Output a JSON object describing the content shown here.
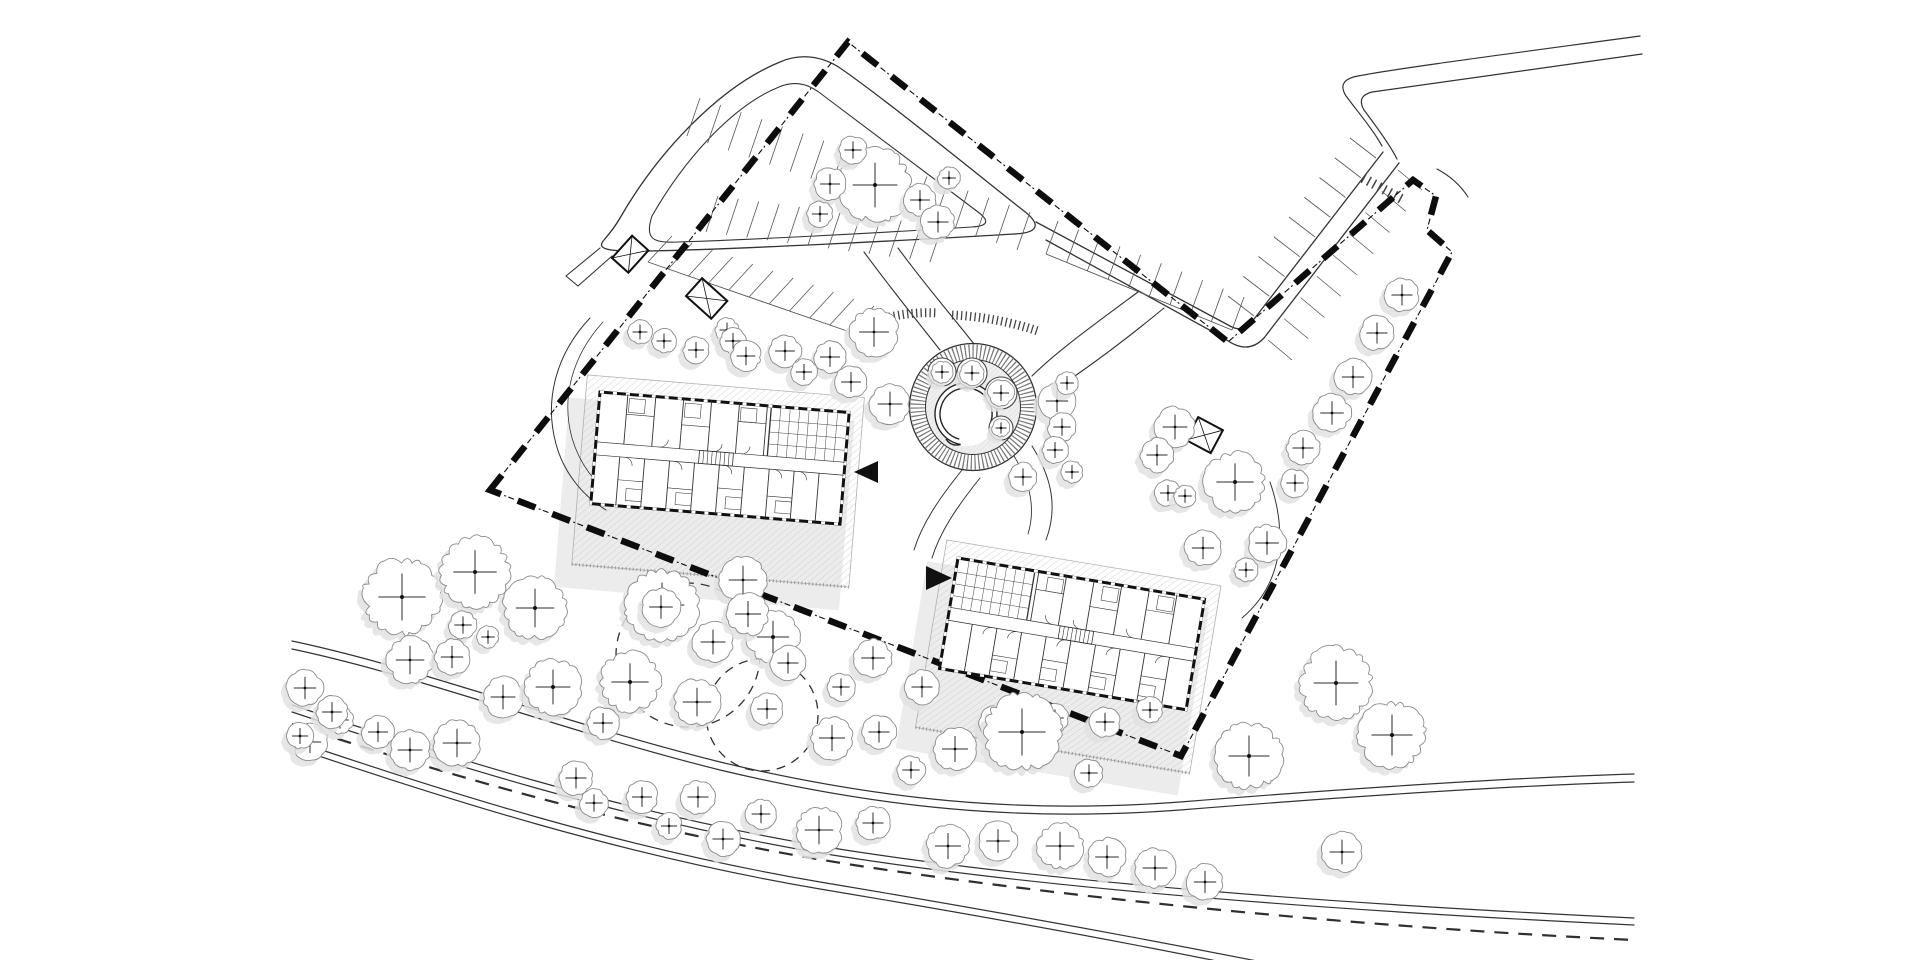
{
  "plan": {
    "kind": "architectural-site-plan",
    "canvas": {
      "w": 1920,
      "h": 960,
      "background": "#ffffff"
    },
    "colors": {
      "line": "#333333",
      "bold": "#111111",
      "tree_stroke": "#8b8b8b",
      "shadow": "#e2e2e2",
      "pad_hatch": "#c9c9c9",
      "pad_edge": "#b0b0b0",
      "stall": "#555555",
      "boundary": "#0d0d0d",
      "plaza_fill": "#efefef"
    },
    "boundary": {
      "path": "M 490,490 L 848,42 L 1228,342 L 1413,180 L 1436,196 L 1427,230 L 1452,252 L 1181,756 Z",
      "thick_dash": "19 18",
      "thin_dash": "0 23 6 2.5 2 3.5",
      "thick_width": 6.5,
      "thin_width": 1.1
    },
    "roads": [
      {
        "name": "top-loop-outer",
        "d": "M 620,218 C 658,152 720,86 780,62 C 800,53 822,56 840,68 C 884,98 992,186 1024,211 C 1042,225 1038,233 1014,234 C 898,241 738,249 650,251 C 606,252 596,249 604,240 C 610,233 615,227 620,218 Z",
        "w": 1.3
      },
      {
        "name": "top-loop-inner",
        "d": "M 652,216 C 684,160 732,106 779,87 C 793,81 807,83 820,93 C 860,123 950,191 978,212 C 990,221 988,226 972,227 C 878,233 744,240 678,242 C 654,243 644,240 652,216 Z",
        "w": 1.1
      },
      {
        "name": "stub-a",
        "d": "M 600,248 L 566,276",
        "w": 1.1
      },
      {
        "name": "stub-b",
        "d": "M 612,256 L 578,286",
        "w": 1.1
      },
      {
        "name": "stub-cap",
        "d": "M 566,276 L 578,286",
        "w": 1.1
      },
      {
        "name": "ne-road-inner",
        "d": "M 1036,222 L 1230,326 Q 1243,333 1251,323 L 1383,152",
        "w": 1.3
      },
      {
        "name": "ne-road-outer",
        "d": "M 1046,240 L 1224,338 Q 1247,356 1264,338 L 1399,163",
        "w": 1.3
      },
      {
        "name": "entry-road-a",
        "d": "M 1640,36 C 1500,55 1400,68 1358,76 Q 1336,80 1346,96 C 1358,112 1374,131 1382,146",
        "w": 1.2
      },
      {
        "name": "entry-road-b",
        "d": "M 1642,54 C 1520,72 1420,85 1372,92 Q 1356,96 1364,110 C 1373,122 1389,143 1397,159",
        "w": 1.2
      },
      {
        "name": "entry-kerb",
        "d": "M 1437,169 C 1452,177 1461,186 1468,197",
        "w": 1.1
      },
      {
        "name": "branch-a",
        "d": "M 1138,292 C 1092,326 1056,352 1032,376",
        "w": 1.1
      },
      {
        "name": "branch-b",
        "d": "M 1164,308 C 1118,346 1082,372 1048,394",
        "w": 1.1
      },
      {
        "name": "loop-to-plaza-a",
        "d": "M 864,252 C 892,290 918,322 940,350",
        "w": 1.1
      },
      {
        "name": "loop-to-plaza-b",
        "d": "M 898,248 C 926,286 952,316 974,344",
        "w": 1.1
      },
      {
        "name": "b1-west-path-a",
        "d": "M 590,318 C 556,354 544,400 556,444 C 563,470 580,494 606,510",
        "w": 1
      },
      {
        "name": "b1-west-path-b",
        "d": "M 603,322 C 572,356 561,398 572,438 C 579,462 594,484 618,500",
        "w": 0.8
      },
      {
        "name": "between-path-a",
        "d": "M 962,470 C 938,500 922,524 914,550",
        "w": 1
      },
      {
        "name": "between-path-b",
        "d": "M 980,478 C 956,508 940,532 932,558",
        "w": 1
      },
      {
        "name": "b2-east-path",
        "d": "M 1270,482 C 1288,534 1282,584 1242,618",
        "w": 1
      },
      {
        "name": "plaza-se-a",
        "d": "M 1032,446 C 1052,478 1058,508 1046,540",
        "w": 1
      },
      {
        "name": "plaza-se-b",
        "d": "M 1014,456 C 1030,482 1036,508 1028,534",
        "w": 0.9
      },
      {
        "name": "lower-path-1a",
        "d": "M 292,641 C 420,668 560,722 720,762 C 880,800 1020,814 1180,802 C 1330,790 1500,778 1634,774",
        "w": 1.2
      },
      {
        "name": "lower-path-1b",
        "d": "M 292,649 C 420,676 560,730 720,770 C 880,808 1020,822 1180,810 C 1330,798 1500,786 1634,782",
        "w": 1.2
      },
      {
        "name": "lower-road-2a",
        "d": "M 292,705 C 440,754 620,812 820,846 C 1040,882 1340,904 1634,918",
        "w": 1.2
      },
      {
        "name": "lower-road-2b",
        "d": "M 292,712 C 440,761 620,819 820,853 C 1040,889 1340,911 1634,925",
        "w": 1.2
      },
      {
        "name": "lower-road-3a",
        "d": "M 292,740 C 440,790 620,848 820,882 C 1000,912 1140,938 1262,962",
        "w": 1.2
      },
      {
        "name": "lower-road-3b",
        "d": "M 292,747 C 440,797 620,855 820,889 C 1000,919 1140,945 1256,969",
        "w": 1.2
      }
    ],
    "dashed_centerline": {
      "d": "M 292,724 C 450,776 640,832 860,866 C 1100,902 1380,928 1634,940",
      "dash": "14 10",
      "w": 2.2
    },
    "stall_bands": [
      {
        "p0": [
          700,
          98
        ],
        "p1": [
          1030,
          212
        ],
        "v": [
          -13,
          38
        ],
        "n": 16,
        "rail": false
      },
      {
        "p0": [
          706,
          232
        ],
        "p1": [
          930,
          262
        ],
        "v": [
          12,
          -36
        ],
        "n": 11,
        "rail": false
      },
      {
        "p0": [
          648,
          262
        ],
        "p1": [
          850,
          332
        ],
        "v": [
          24,
          -26
        ],
        "n": 10,
        "rail": true
      },
      {
        "p0": [
          1046,
          254
        ],
        "p1": [
          1232,
          330
        ],
        "v": [
          12,
          -33
        ],
        "n": 9,
        "rail": true
      },
      {
        "p0": [
          1254,
          316
        ],
        "p1": [
          1376,
          158
        ],
        "v": [
          -26,
          -20
        ],
        "n": 8,
        "rail": false
      },
      {
        "p0": [
          1268,
          340
        ],
        "p1": [
          1398,
          170
        ],
        "v": [
          24,
          20
        ],
        "n": 8,
        "rail": false
      }
    ],
    "tick_bands": [
      {
        "d": "M 872,322 Q 905,311 938,313",
        "w": 9,
        "dash": "1.3 3.2"
      },
      {
        "d": "M 952,315 Q 996,317 1038,331",
        "w": 9,
        "dash": "1.3 3.2"
      },
      {
        "d": "M 1363,178 L 1405,201",
        "w": 10,
        "dash": "1.5 4.5"
      }
    ],
    "plaza": {
      "cx": 973,
      "cy": 407,
      "r_outer": 63.5,
      "r_ring": 55,
      "r_inner": 47.5,
      "ring_width": 15,
      "ring_dash": "1.2 2.6",
      "court": {
        "cx": 966,
        "cy": 414,
        "r": 32
      },
      "wall_arcs": [
        "M 960.6,444.5 A 31 31 0 1 1 992.8,429.5",
        "M 959.3,439.1 A 26 26 0 1 1 989.6,425.0",
        "M 992.8,429.5 L 989.6,425.0",
        "M 960.6,444.5 Q 951,447 946,439"
      ],
      "planters": [
        [
          942,
          372,
          14
        ],
        [
          972,
          373,
          15
        ],
        [
          1001,
          393,
          16
        ],
        [
          1001,
          428,
          12
        ]
      ]
    },
    "buildings": [
      {
        "name": "building-1",
        "x": 600,
        "y": 392,
        "rot": 4.7,
        "mirror": false
      },
      {
        "name": "building-2",
        "x": 958,
        "y": 558,
        "rot": 9.5,
        "mirror": true
      }
    ],
    "building_plan": {
      "w": 250,
      "h": 112,
      "corridor": [
        50,
        63
      ],
      "top_walls": [
        28,
        56,
        84,
        112,
        140,
        168
      ],
      "bottom_walls": [
        25,
        50,
        75,
        100,
        125,
        150,
        175,
        200,
        225
      ],
      "grid": {
        "x0": 172,
        "x1": 248,
        "y0": 2,
        "y1": 50,
        "cols": 7,
        "rows": 3
      },
      "stair": [
        104,
        50,
        34,
        13
      ],
      "doors": [
        "M 30,63 a8,8 0 0 1 8,8",
        "M 80,63 a8,8 0 0 1 8,8",
        "M 130,63 a8,8 0 0 1 8,8",
        "M 180,63 a8,8 0 0 1 8,8",
        "M 205,63 a8,8 0 0 1 8,8",
        "M 64,50 a8,8 0 0 0 8,-8",
        "M 118,50 a8,8 0 0 0 8,-8",
        "M 146,50 a8,8 0 0 0 8,-8"
      ],
      "inner": [
        [
          28,
          20,
          56,
          20
        ],
        [
          84,
          26,
          112,
          26
        ],
        [
          140,
          18,
          168,
          18
        ],
        [
          25,
          86,
          50,
          86
        ],
        [
          75,
          90,
          100,
          90
        ],
        [
          125,
          86,
          150,
          86
        ],
        [
          175,
          90,
          200,
          90
        ]
      ],
      "cells": [
        [
          30,
          4,
          16,
          14
        ],
        [
          86,
          4,
          16,
          14
        ],
        [
          142,
          4,
          16,
          14
        ],
        [
          34,
          94,
          16,
          12
        ],
        [
          84,
          94,
          16,
          12
        ],
        [
          134,
          94,
          16,
          12
        ],
        [
          184,
          94,
          16,
          12
        ]
      ],
      "pad": {
        "dx": -14,
        "dy": -16,
        "ex": 28,
        "ey": 78
      },
      "shadow": {
        "dx": -30,
        "dy": 8,
        "ex": 36,
        "ey": 78
      }
    },
    "structures": [
      {
        "name": "bin-store-1",
        "x": 612,
        "y": 258,
        "rot": -48,
        "w": 30,
        "h": 22
      },
      {
        "name": "bin-store-2",
        "x": 686,
        "y": 296,
        "rot": -48,
        "w": 24,
        "h": 34
      },
      {
        "name": "bin-store-3",
        "x": 1186,
        "y": 440,
        "rot": -62,
        "w": 26,
        "h": 28
      }
    ],
    "arrows": [
      {
        "name": "entrance-arrow-building-1",
        "points": "878,461 878,483 854,472"
      },
      {
        "name": "entrance-arrow-building-2",
        "points": "926,566 926,590 952,578"
      }
    ],
    "dashed_arcs": [
      {
        "cx": 688,
        "cy": 655,
        "r": 72
      },
      {
        "cx": 762,
        "cy": 715,
        "r": 56
      }
    ],
    "trees": [
      [
        875,
        185,
        36
      ],
      [
        853,
        150,
        14
      ],
      [
        830,
        184,
        16
      ],
      [
        820,
        214,
        13
      ],
      [
        920,
        200,
        16
      ],
      [
        938,
        222,
        17
      ],
      [
        949,
        178,
        11
      ],
      [
        640,
        332,
        12
      ],
      [
        664,
        341,
        12
      ],
      [
        696,
        350,
        13
      ],
      [
        727,
        330,
        12
      ],
      [
        733,
        341,
        13
      ],
      [
        746,
        356,
        15
      ],
      [
        785,
        351,
        16
      ],
      [
        830,
        357,
        16
      ],
      [
        804,
        372,
        13
      ],
      [
        874,
        332,
        24
      ],
      [
        851,
        382,
        16
      ],
      [
        890,
        404,
        20
      ],
      [
        1057,
        401,
        18
      ],
      [
        1062,
        427,
        14
      ],
      [
        1055,
        450,
        13
      ],
      [
        1072,
        472,
        11
      ],
      [
        1023,
        477,
        14
      ],
      [
        1067,
        383,
        11
      ],
      [
        1402,
        295,
        17
      ],
      [
        1377,
        333,
        17
      ],
      [
        1353,
        377,
        18
      ],
      [
        1332,
        413,
        19
      ],
      [
        1303,
        448,
        17
      ],
      [
        1295,
        483,
        14
      ],
      [
        1267,
        543,
        19
      ],
      [
        1246,
        570,
        12
      ],
      [
        1235,
        482,
        30
      ],
      [
        1175,
        427,
        20
      ],
      [
        1157,
        455,
        17
      ],
      [
        1168,
        493,
        13
      ],
      [
        1185,
        496,
        11
      ],
      [
        1203,
        548,
        18
      ],
      [
        1336,
        683,
        36
      ],
      [
        1392,
        735,
        33
      ],
      [
        1249,
        756,
        33
      ],
      [
        1342,
        852,
        20
      ],
      [
        995,
        722,
        16
      ],
      [
        1055,
        718,
        14
      ],
      [
        1105,
        722,
        15
      ],
      [
        1150,
        710,
        13
      ],
      [
        1089,
        773,
        14
      ],
      [
        942,
        372,
        11
      ],
      [
        972,
        373,
        12
      ],
      [
        1001,
        393,
        13
      ],
      [
        1001,
        428,
        9
      ],
      [
        402,
        597,
        38
      ],
      [
        475,
        572,
        35
      ],
      [
        535,
        608,
        31
      ],
      [
        463,
        625,
        14
      ],
      [
        488,
        637,
        11
      ],
      [
        410,
        660,
        23
      ],
      [
        452,
        657,
        18
      ],
      [
        503,
        697,
        20
      ],
      [
        553,
        687,
        28
      ],
      [
        630,
        682,
        30
      ],
      [
        662,
        605,
        36
      ],
      [
        713,
        642,
        20
      ],
      [
        697,
        702,
        23
      ],
      [
        603,
        723,
        16
      ],
      [
        457,
        743,
        23
      ],
      [
        410,
        750,
        20
      ],
      [
        378,
        732,
        16
      ],
      [
        743,
        580,
        23
      ],
      [
        773,
        637,
        26
      ],
      [
        310,
        742,
        18
      ],
      [
        340,
        720,
        14
      ],
      [
        305,
        688,
        18
      ],
      [
        332,
        712,
        16
      ],
      [
        300,
        736,
        13
      ],
      [
        661,
        607,
        19
      ],
      [
        748,
        614,
        21
      ],
      [
        788,
        663,
        17
      ],
      [
        873,
        658,
        19
      ],
      [
        841,
        687,
        14
      ],
      [
        922,
        687,
        17
      ],
      [
        767,
        709,
        16
      ],
      [
        832,
        738,
        21
      ],
      [
        879,
        732,
        17
      ],
      [
        955,
        749,
        21
      ],
      [
        1022,
        732,
        38
      ],
      [
        911,
        770,
        14
      ],
      [
        576,
        778,
        17
      ],
      [
        594,
        803,
        14
      ],
      [
        642,
        797,
        16
      ],
      [
        698,
        797,
        17
      ],
      [
        669,
        826,
        13
      ],
      [
        723,
        839,
        17
      ],
      [
        761,
        814,
        15
      ],
      [
        819,
        830,
        23
      ],
      [
        873,
        823,
        17
      ],
      [
        948,
        846,
        21
      ],
      [
        998,
        841,
        19
      ],
      [
        1060,
        846,
        23
      ],
      [
        1107,
        857,
        19
      ],
      [
        1155,
        868,
        20
      ],
      [
        1205,
        882,
        18
      ]
    ]
  }
}
